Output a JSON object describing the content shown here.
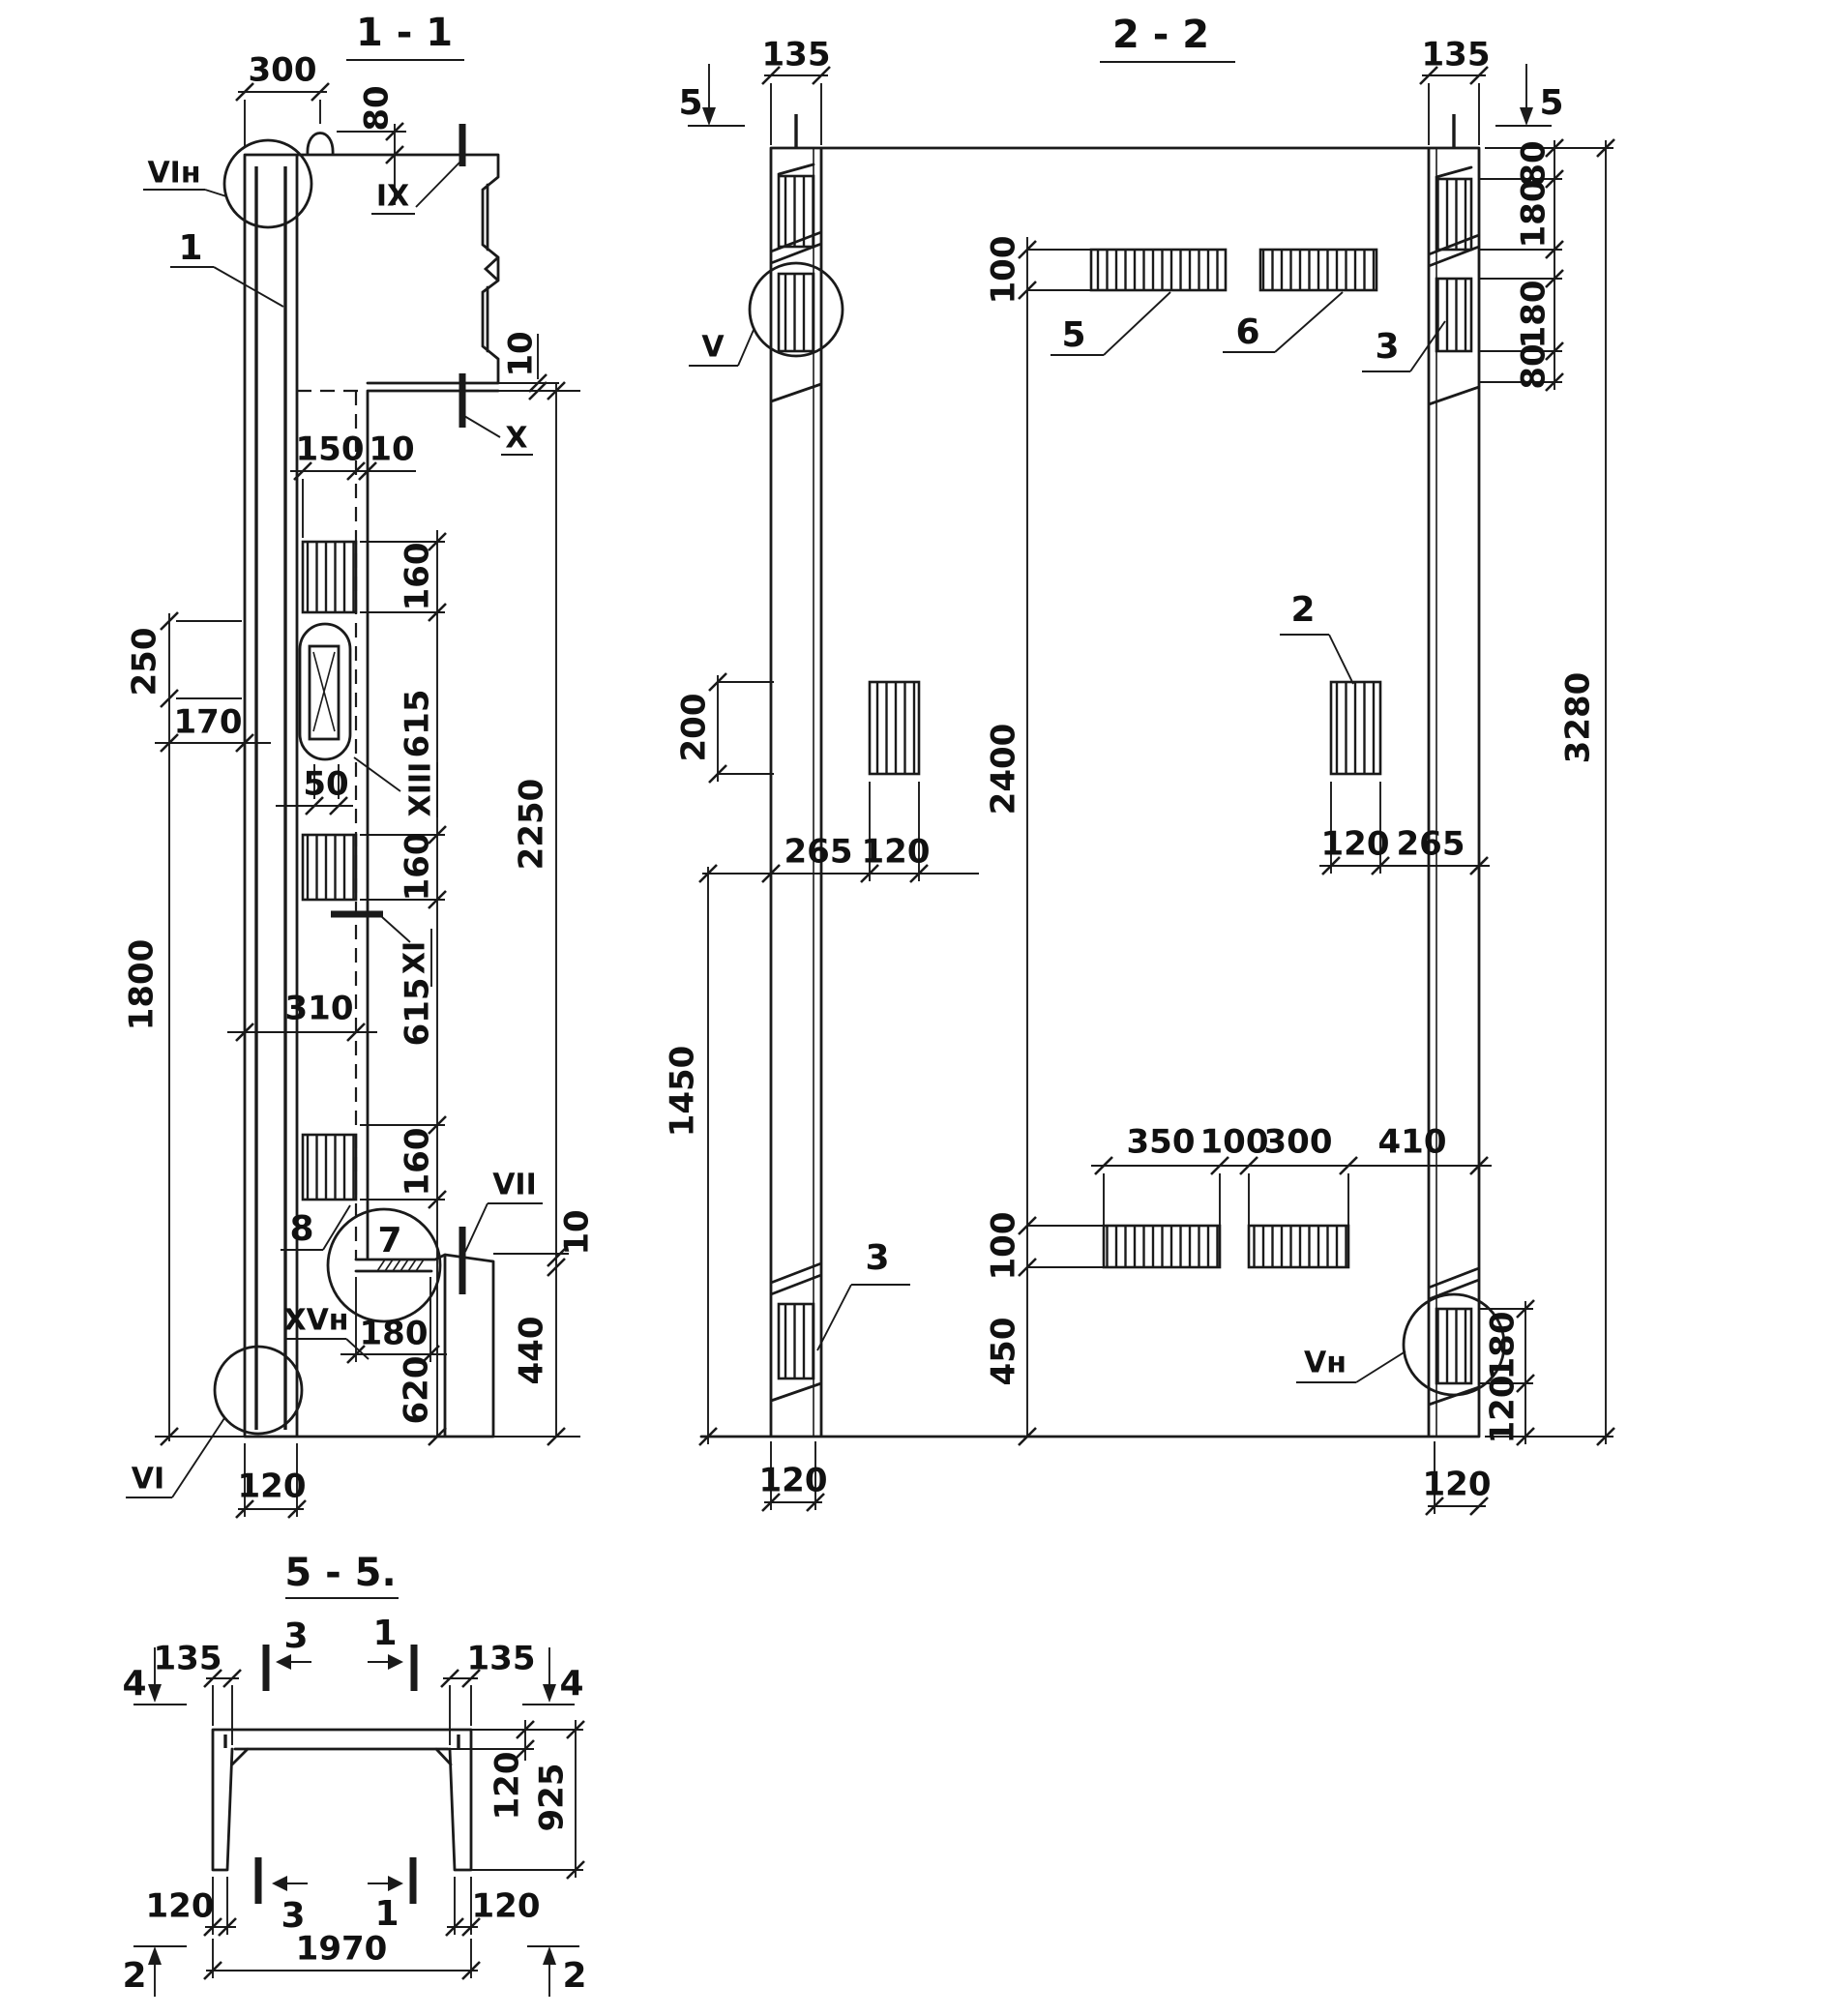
{
  "colors": {
    "ink": "#1a1a1a",
    "paper": "#ffffff"
  },
  "s11": {
    "title": "1 - 1",
    "d300": "300",
    "d80": "80",
    "d10top": "10",
    "d150": "150",
    "d10lip": "10",
    "chain": [
      "160",
      "615",
      "160",
      "615",
      "160"
    ],
    "d620": "620",
    "d2250": "2250",
    "d10bot": "10",
    "d440": "440",
    "d250": "250",
    "d170": "170",
    "d50": "50",
    "d310": "310",
    "d1800": "1800",
    "d180": "180",
    "d120": "120",
    "mVIn": "VIн",
    "mIX": "IX",
    "mX": "X",
    "mXI": "XI",
    "mXIII": "XIII",
    "mVII": "VII",
    "mXVn": "XVн",
    "mVI": "VI",
    "p1": "1",
    "p7": "7",
    "p8": "8"
  },
  "s22": {
    "title": "2 - 2",
    "d135l": "135",
    "d135r": "135",
    "sec5": "5",
    "rchain": [
      "80",
      "180",
      "180",
      "80"
    ],
    "d100t": "100",
    "d2400": "2400",
    "d100b": "100",
    "d450": "450",
    "d3280": "3280",
    "d200": "200",
    "d265l": "265",
    "d120l": "120",
    "d120r": "120",
    "d265r": "265",
    "d1450": "1450",
    "bchain": [
      "350",
      "100",
      "300",
      "410"
    ],
    "d180rb": "180",
    "d120rb": "120",
    "d120bl": "120",
    "d120br": "120",
    "mV": "V",
    "mVn": "Vн",
    "p2": "2",
    "p3": "3",
    "p5": "5",
    "p6": "6"
  },
  "s55": {
    "title": "5 - 5.",
    "d135l": "135",
    "d135r": "135",
    "d120s": "120",
    "d925": "925",
    "d120bl": "120",
    "d120br": "120",
    "d1970": "1970",
    "m4": "4",
    "m2": "2",
    "c3": "3",
    "c1": "1"
  }
}
